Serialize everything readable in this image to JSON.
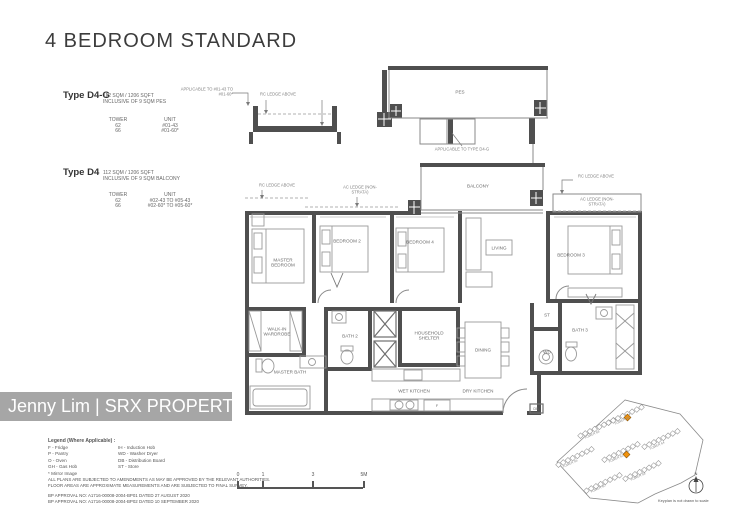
{
  "title": "4 BEDROOM STANDARD",
  "types": [
    {
      "name": "Type D4-G",
      "area_line1": "112 SQM / 1206 SQFT",
      "area_line2": "INCLUSIVE OF 9 SQM PES",
      "tower_header": "TOWER",
      "unit_header": "UNIT",
      "rows": [
        {
          "tower": "62",
          "unit": "#01-43"
        },
        {
          "tower": "66",
          "unit": "#01-60*"
        }
      ]
    },
    {
      "name": "Type D4",
      "area_line1": "112 SQM / 1206 SQFT",
      "area_line2": "INCLUSIVE OF 9 SQM BALCONY",
      "tower_header": "TOWER",
      "unit_header": "UNIT",
      "rows": [
        {
          "tower": "62",
          "unit": "#02-43 TO #05-43"
        },
        {
          "tower": "66",
          "unit": "#02-60* TO #05-60*"
        }
      ]
    }
  ],
  "plan": {
    "rooms": {
      "master_bedroom": "MASTER BEDROOM",
      "bedroom2": "BEDROOM 2",
      "bedroom3": "BEDROOM 3",
      "bedroom4": "BEDROOM 4",
      "living": "LIVING",
      "dining": "DINING",
      "balcony": "BALCONY",
      "pes": "PES",
      "walk_in_wardrobe": "WALK-IN WARDROBE",
      "master_bath": "MASTER BATH",
      "bath2": "BATH 2",
      "bath3": "BATH 3",
      "household_shelter": "HOUSEHOLD SHELTER",
      "wet_kitchen": "WET KITCHEN",
      "dry_kitchen": "DRY KITCHEN",
      "st": "ST",
      "wd": "WD",
      "db": "DB",
      "f": "F"
    },
    "annotations": {
      "rc_ledge": "RC LEDGE ABOVE",
      "ac_ledge": "AC LEDGE (NON-STRATA)",
      "applicable_type": "APPLICABLE TO TYPE D4-G",
      "applicable_units": "APPLICABLE TO #01-43 TO #01-60*"
    }
  },
  "watermark": "Jenny Lim | SRX PROPERTY",
  "legend": {
    "title": "Legend (Where Applicable) :",
    "rows": [
      {
        "left": "F - Fridge",
        "right": "IH - Induction Hob"
      },
      {
        "left": "P - Pantry",
        "right": "WD - Washer Dryer"
      },
      {
        "left": "O - Oven",
        "right": "DB - Distribution Board"
      },
      {
        "left": "GH - Gas Hob",
        "right": "ST - Store"
      },
      {
        "left": "* Mirror Image",
        "right": ""
      }
    ],
    "disclaimer_line1": "ALL PLANS ARE SUBJECTED TO AMENDMENTS AS MAY BE APPROVED BY THE RELEVANT AUTHORITIES.",
    "disclaimer_line2": "FLOOR AREAS ARE APPROXIMATE MEASUREMENTS AND ARE SUBJECTED TO FINAL SURVEY.",
    "approval_line1": "BP APPROVAL NO: A1716-00008-2004-BP01  DATED 27 AUGUST 2020",
    "approval_line2": "BP APPROVAL NO: A1716-00008-2004-BP02  DATED 10 SEPTEMBER 2020"
  },
  "scalebar": {
    "ticks": [
      "0",
      "1",
      "3",
      "5M"
    ]
  },
  "keyplan": {
    "note": "Keyplan is not drawn to scale",
    "north_label": "N",
    "towers": [
      "TOWER 68",
      "TOWER 66",
      "TOWER 64",
      "TOWER 56",
      "TOWER 62",
      "TOWER 60",
      "TOWER 58"
    ]
  },
  "colors": {
    "wall": "#4f4f4f",
    "accent": "#f0920e",
    "watermark_bg": "#a6a6a6"
  }
}
